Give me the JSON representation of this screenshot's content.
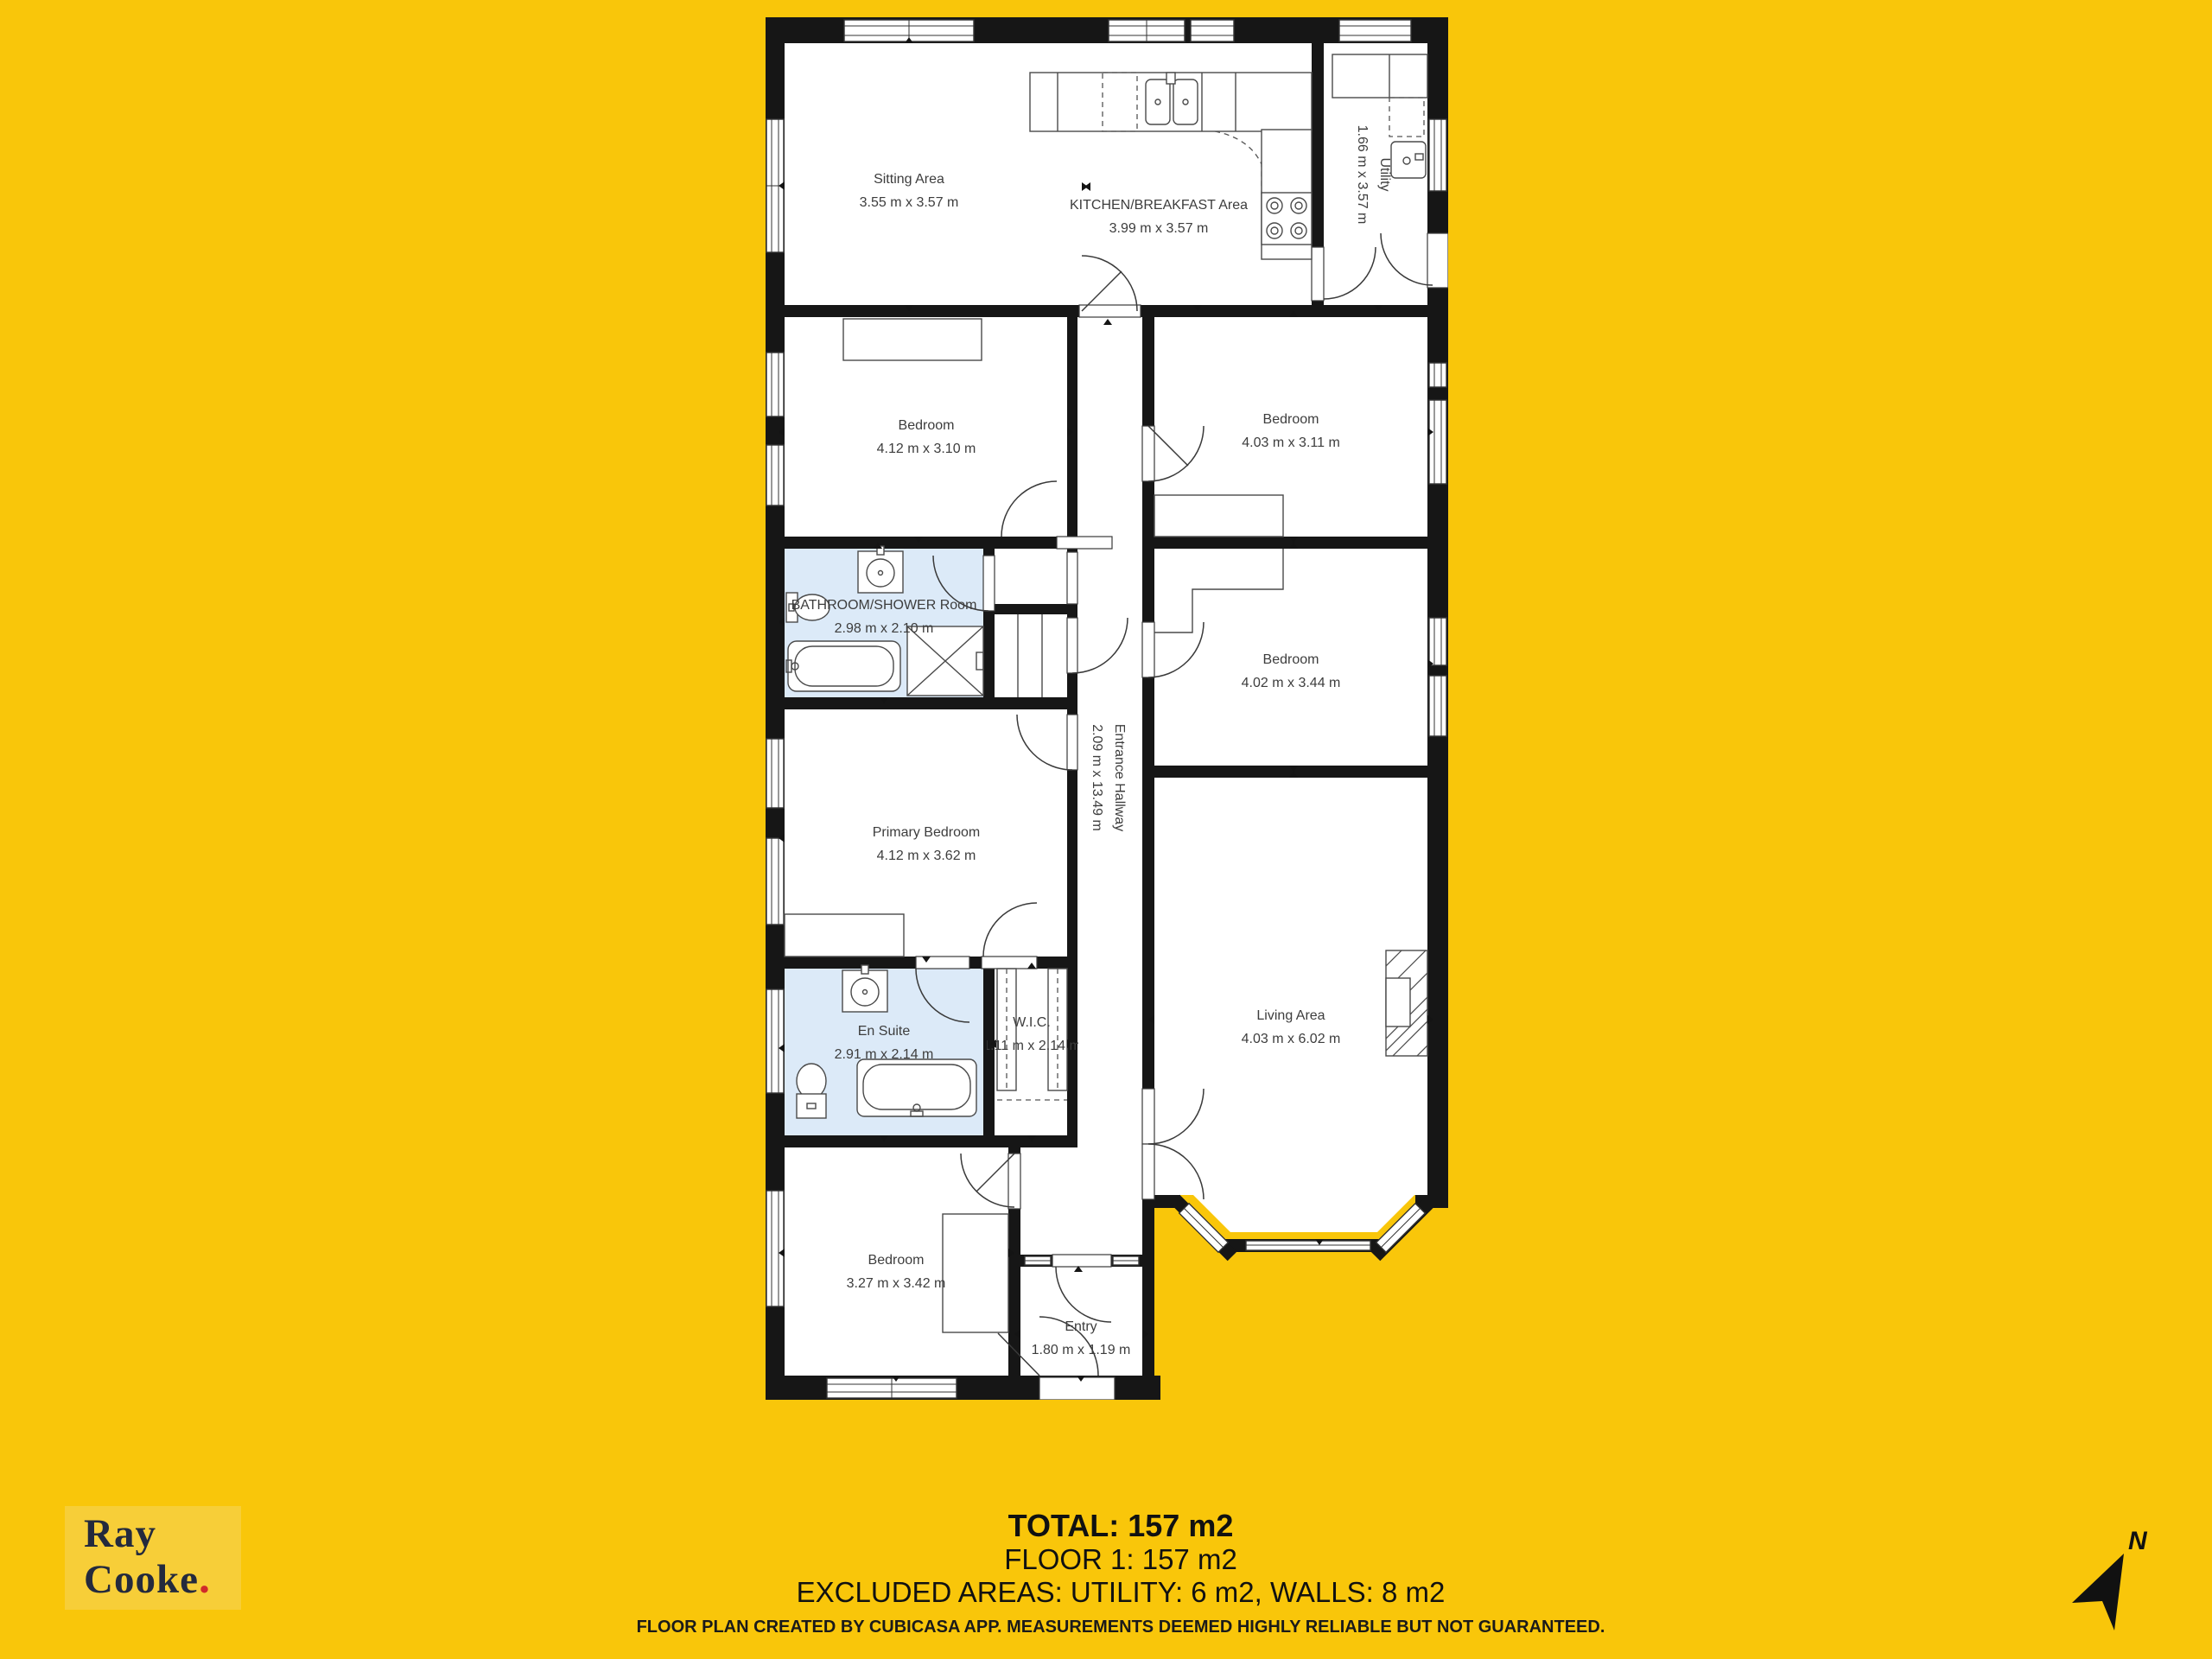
{
  "colors": {
    "page_bg": "#F9C60A",
    "logo_bg": "#F7CE38",
    "logo_text": "#242A3D",
    "logo_dot": "#D02A2A",
    "wall": "#161616",
    "bathroom_fill": "#DCEAF8"
  },
  "rooms": {
    "sitting": {
      "name": "Sitting Area",
      "dims": "3.55 m x 3.57 m"
    },
    "kitchen": {
      "name": "KITCHEN/BREAKFAST Area",
      "dims": "3.99 m x 3.57 m"
    },
    "utility": {
      "name": "Utility",
      "dims": "1.66 m x 3.57 m"
    },
    "bedroom_top_left": {
      "name": "Bedroom",
      "dims": "4.12 m x 3.10 m"
    },
    "bedroom_top_right": {
      "name": "Bedroom",
      "dims": "4.03 m x 3.11 m"
    },
    "bathroom": {
      "name": "BATHROOM/SHOWER Room",
      "dims": "2.98 m x 2.10 m"
    },
    "bedroom_mid_right": {
      "name": "Bedroom",
      "dims": "4.02 m x 3.44 m"
    },
    "primary": {
      "name": "Primary Bedroom",
      "dims": "4.12 m x 3.62 m"
    },
    "hallway": {
      "name": "Entrance Hallway",
      "dims": "2.09 m x 13.49 m"
    },
    "en_suite": {
      "name": "En Suite",
      "dims": "2.91 m x 2.14 m"
    },
    "wic": {
      "name": "W.I.C.",
      "dims": "1.11 m x 2.14 m"
    },
    "living": {
      "name": "Living Area",
      "dims": "4.03 m x 6.02 m"
    },
    "bedroom_bottom": {
      "name": "Bedroom",
      "dims": "3.27 m x 3.42 m"
    },
    "entry": {
      "name": "Entry",
      "dims": "1.80 m x 1.19 m"
    }
  },
  "summary": {
    "total": "TOTAL: 157 m2",
    "floor": "FLOOR 1: 157 m2",
    "excluded": "EXCLUDED AREAS: UTILITY: 6 m2, WALLS: 8 m2"
  },
  "footer": {
    "disclaimer": "FLOOR PLAN CREATED BY CUBICASA APP. MEASUREMENTS DEEMED HIGHLY RELIABLE BUT NOT GUARANTEED."
  },
  "branding": {
    "line1": "Ray",
    "line2": "Cooke",
    "dot": "."
  },
  "compass": {
    "label": "N"
  }
}
